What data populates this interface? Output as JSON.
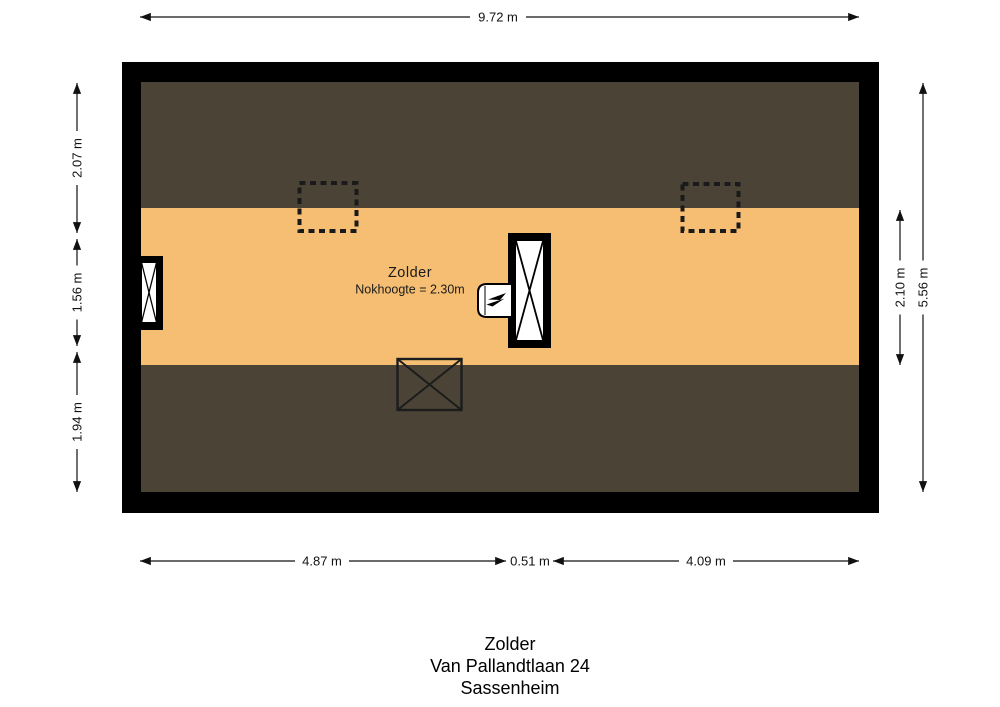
{
  "floorplan": {
    "room": {
      "name": "Zolder",
      "ridge_height": "Nokhoogte = 2.30m"
    },
    "colors": {
      "wall": "#000000",
      "floor": "#F6BE72",
      "low_headroom": "#4B4336",
      "dim_line": "#111111"
    },
    "symbols": [
      "roof-window-dashed",
      "roof-window-dashed",
      "window",
      "stairs-opening",
      "boiler",
      "floor-opening"
    ]
  },
  "dimensions": {
    "top": "9.72 m",
    "left": [
      "2.07 m",
      "1.56 m",
      "1.94 m"
    ],
    "right": [
      "2.10 m",
      "5.56 m"
    ],
    "bottom": [
      "4.87 m",
      "0.51 m",
      "4.09 m"
    ]
  },
  "caption": [
    "Zolder",
    "Van Pallandtlaan 24",
    "Sassenheim"
  ]
}
